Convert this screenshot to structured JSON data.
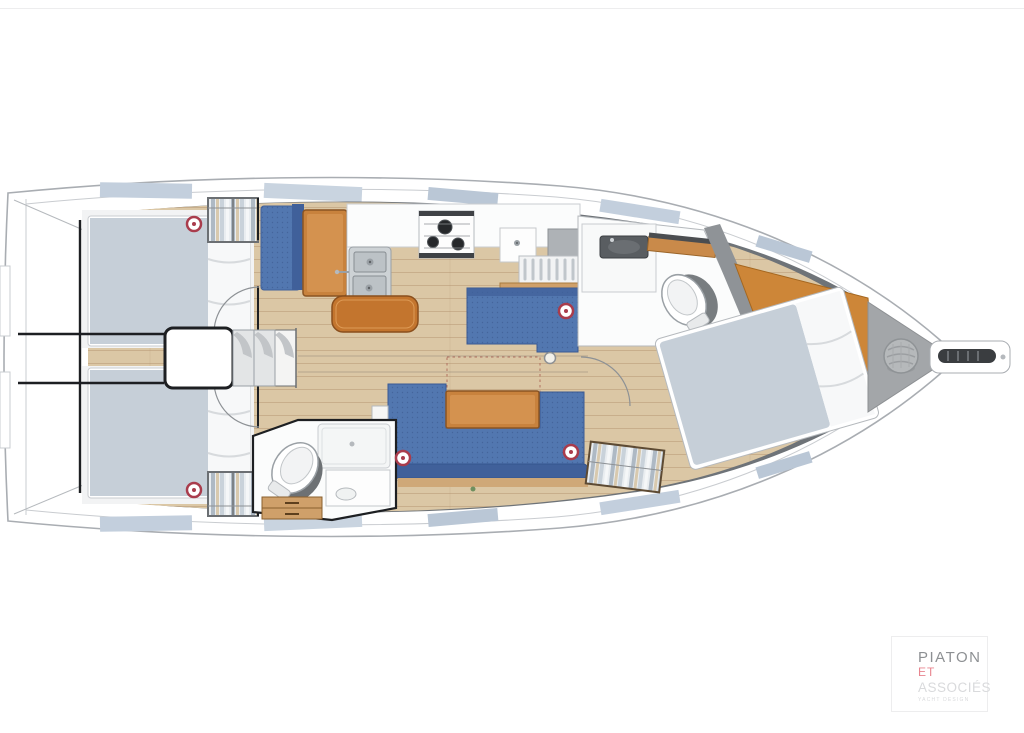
{
  "page": {
    "type": "sailboat interior layout plan, top view"
  },
  "logo": {
    "line1": "PIATON",
    "line2": "ET",
    "line3": "ASSOCIÉS",
    "tagline": "YACHT DESIGN"
  },
  "palette": {
    "c-hull-stroke": "#a9adb2",
    "c-band": "#6e7378",
    "c-hatch": "#c3cfdd",
    "c-floor": "#dbc7a5",
    "c-mattress": "#c6cfd8",
    "c-sofa": "#5277b0",
    "c-sofa-dark": "#40609a",
    "c-wood": "#c8823d",
    "c-counter": "#fbfcfc",
    "c-red": "#a93c4c",
    "c-bow": "#a3a6a9",
    "logo-gray": "#8d9093",
    "logo-pink": "#e8858f",
    "logo-light": "#d9dadc"
  },
  "features": [
    "aft-cabin-port-berth",
    "aft-cabin-starboard-berth",
    "wardrobes",
    "companionway-steps",
    "galley-double-sink",
    "galley-stove-3-burners",
    "galley-dish-rack",
    "chart-table",
    "salon-settee-port",
    "salon-u-settee",
    "salon-table",
    "folding-table-extension-outline",
    "mast-post",
    "aft-head-toilet",
    "aft-head-shower",
    "forward-head-toilet",
    "forward-head-vanity",
    "forward-v-berth",
    "hanging-locker",
    "anchor-locker-rope-coil",
    "bowsprit-anchor-chain",
    "ceiling-light-markers"
  ]
}
